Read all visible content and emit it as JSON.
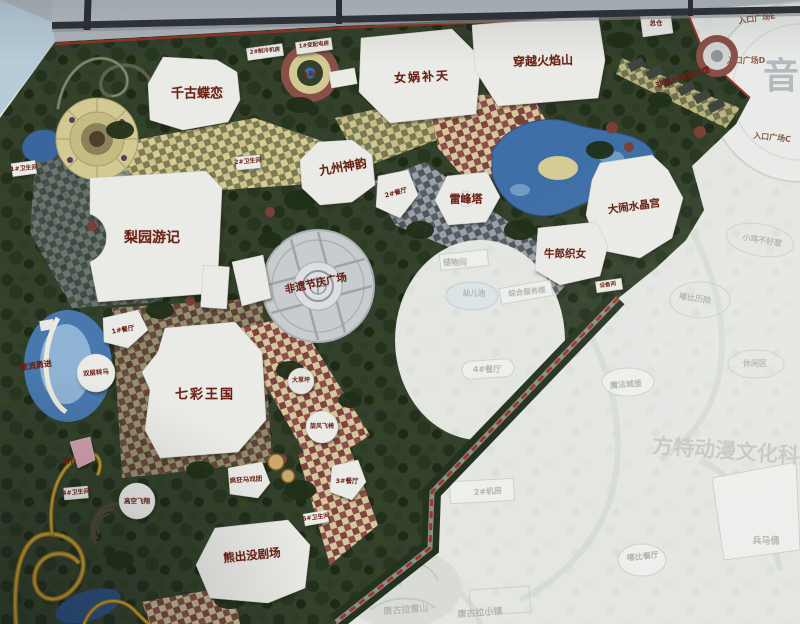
{
  "colors": {
    "attraction_label_red": "#6b2014",
    "faded_label_gray": "#b2b6af",
    "park_green": "#33402c",
    "water_blue": "#3f6fa8",
    "boundary_road_red": "#a03428",
    "plaza_gray": "#c8ccce",
    "building_white": "#eaeae6"
  },
  "map_labels": [
    {
      "id": "qiangu-dielian",
      "text": "千古蝶恋",
      "x": 197,
      "y": 94,
      "fs": 13,
      "type": "major"
    },
    {
      "id": "nvwa-butian",
      "text": "女娲补天",
      "x": 422,
      "y": 77,
      "fs": 12,
      "ls": 2,
      "rot": -3,
      "type": "major"
    },
    {
      "id": "chuanyue-huoyanshan",
      "text": "穿越火焰山",
      "x": 543,
      "y": 61,
      "fs": 12,
      "rot": -2,
      "type": "major"
    },
    {
      "id": "jiuzhou-shenyun",
      "text": "九州神韵",
      "x": 343,
      "y": 167,
      "fs": 12,
      "rot": -10,
      "type": "major"
    },
    {
      "id": "leifeng-ta",
      "text": "雷峰塔",
      "x": 466,
      "y": 199,
      "fs": 11,
      "type": "major"
    },
    {
      "id": "danao-shuijinggong",
      "text": "大闹水晶宫",
      "x": 634,
      "y": 207,
      "fs": 10.5,
      "rot": -8,
      "type": "major"
    },
    {
      "id": "niulang-zhinv",
      "text": "牛郎织女",
      "x": 565,
      "y": 254,
      "fs": 10.5,
      "type": "major"
    },
    {
      "id": "liyuan-youji",
      "text": "梨园游记",
      "x": 152,
      "y": 238,
      "fs": 14,
      "type": "major"
    },
    {
      "id": "qicai-wangguo",
      "text": "七彩王国",
      "x": 205,
      "y": 395,
      "fs": 13,
      "ls": 2,
      "type": "major"
    },
    {
      "id": "xiongchumo-juchang",
      "text": "熊出没剧场",
      "x": 252,
      "y": 556,
      "fs": 11.5,
      "rot": -6,
      "type": "major"
    },
    {
      "id": "feiyi-jieqing-guangchang",
      "text": "非遗节庆广场",
      "x": 316,
      "y": 284,
      "fs": 10.5,
      "rot": -12,
      "type": "major"
    },
    {
      "id": "feiyi-xiaozhen-exhibit",
      "text": "非遗小镇展示馆",
      "x": 683,
      "y": 78,
      "fs": 8,
      "rot": -17,
      "type": "major"
    },
    {
      "id": "jiliu-yongjin",
      "text": "激流勇进",
      "x": 36,
      "y": 366,
      "fs": 8,
      "rot": -8,
      "type": "major"
    },
    {
      "id": "zongcang",
      "text": "总仓",
      "x": 656,
      "y": 23,
      "fs": 6.5,
      "type": "minor"
    },
    {
      "id": "lengji-fang",
      "text": "2#制冷机房",
      "x": 265,
      "y": 52,
      "fs": 5.5,
      "rot": -6,
      "type": "minor"
    },
    {
      "id": "peidian-fang",
      "text": "1#变配电房",
      "x": 314,
      "y": 46,
      "fs": 5.5,
      "rot": -6,
      "type": "minor"
    },
    {
      "id": "yufu-shan",
      "text": "鱼凫山",
      "x": 311,
      "y": 75,
      "fs": 6,
      "rot": -5,
      "type": "minor"
    },
    {
      "id": "restroom-1",
      "text": "1#卫生间",
      "x": 24,
      "y": 169,
      "fs": 6,
      "rot": -5,
      "type": "minor"
    },
    {
      "id": "restroom-2",
      "text": "2#卫生间",
      "x": 248,
      "y": 162,
      "fs": 6,
      "rot": -5,
      "type": "minor"
    },
    {
      "id": "restaurant-2",
      "text": "2#餐厅",
      "x": 396,
      "y": 193,
      "fs": 6.5,
      "rot": -15,
      "type": "minor"
    },
    {
      "id": "restaurant-1",
      "text": "1#餐厅",
      "x": 123,
      "y": 330,
      "fs": 6.5,
      "rot": -10,
      "type": "minor"
    },
    {
      "id": "shuangceng-zhuanma",
      "text": "双层转马",
      "x": 96,
      "y": 373,
      "fs": 6.5,
      "rot": -5,
      "type": "minor"
    },
    {
      "id": "da-caoping",
      "text": "大草坪",
      "x": 301,
      "y": 381,
      "fs": 6,
      "type": "minor"
    },
    {
      "id": "xuanfeng-feiyi",
      "text": "旋风飞椅",
      "x": 322,
      "y": 427,
      "fs": 6,
      "type": "minor"
    },
    {
      "id": "restaurant-3",
      "text": "3#餐厅",
      "x": 347,
      "y": 481,
      "fs": 6.5,
      "type": "minor"
    },
    {
      "id": "wutai",
      "text": "舞台",
      "x": 70,
      "y": 461,
      "fs": 6.5,
      "type": "minor"
    },
    {
      "id": "gaokong-feixiang",
      "text": "高空飞翔",
      "x": 137,
      "y": 501,
      "fs": 6.5,
      "type": "minor"
    },
    {
      "id": "restroom-4",
      "text": "4#卫生间",
      "x": 76,
      "y": 493,
      "fs": 6,
      "rot": -5,
      "type": "minor"
    },
    {
      "id": "fengkuang-maxituan",
      "text": "疯狂马戏团",
      "x": 246,
      "y": 480,
      "fs": 6.5,
      "rot": -4,
      "type": "minor"
    },
    {
      "id": "restroom-5",
      "text": "5#卫生间",
      "x": 316,
      "y": 518,
      "fs": 6,
      "rot": -8,
      "type": "minor"
    },
    {
      "id": "shebei-jian",
      "text": "设备间",
      "x": 608,
      "y": 286,
      "fs": 5.5,
      "rot": -8,
      "type": "minor"
    },
    {
      "id": "entrance-plaza-e",
      "text": "入口广场E",
      "x": 757,
      "y": 19,
      "fs": 8,
      "rot": -8,
      "type": "gate"
    },
    {
      "id": "entrance-plaza-d",
      "text": "入口广场D",
      "x": 746,
      "y": 61,
      "fs": 8,
      "type": "gate"
    },
    {
      "id": "entrance-plaza-c",
      "text": "入口广场C",
      "x": 772,
      "y": 138,
      "fs": 8,
      "rot": 6,
      "type": "gate"
    },
    {
      "id": "chuwu-jian",
      "text": "储物间",
      "x": 455,
      "y": 263,
      "fs": 8,
      "type": "faded"
    },
    {
      "id": "youer-chi",
      "text": "幼儿池",
      "x": 474,
      "y": 293,
      "fs": 7.5,
      "type": "faded"
    },
    {
      "id": "zonghe-fuwulou",
      "text": "综合服务楼",
      "x": 527,
      "y": 292,
      "fs": 7.5,
      "rot": -6,
      "type": "faded"
    },
    {
      "id": "restaurant-4",
      "text": "4#餐厅",
      "x": 487,
      "y": 370,
      "fs": 8,
      "type": "faded"
    },
    {
      "id": "mofa-chengbao",
      "text": "魔法城堡",
      "x": 626,
      "y": 385,
      "fs": 8,
      "rot": -4,
      "type": "faded"
    },
    {
      "id": "jifang-2",
      "text": "2#机房",
      "x": 488,
      "y": 492,
      "fs": 8,
      "rot": -4,
      "type": "faded"
    },
    {
      "id": "tanggula-xueshan",
      "text": "唐古拉雪山",
      "x": 406,
      "y": 611,
      "fs": 9,
      "rot": -4,
      "type": "faded"
    },
    {
      "id": "tanggula-xiaozhen",
      "text": "唐古拉小镇",
      "x": 480,
      "y": 614,
      "fs": 9,
      "rot": -4,
      "type": "faded"
    },
    {
      "id": "xiaoji-buhaore",
      "text": "小鸡不好惹",
      "x": 762,
      "y": 241,
      "fs": 8,
      "rot": 10,
      "type": "faded"
    },
    {
      "id": "dubi-lixian",
      "text": "嘟比历险",
      "x": 695,
      "y": 299,
      "fs": 8,
      "rot": 8,
      "type": "faded"
    },
    {
      "id": "xiuxian-qu",
      "text": "休闲区",
      "x": 755,
      "y": 364,
      "fs": 8,
      "type": "faded"
    },
    {
      "id": "dubi-canting",
      "text": "嘟比餐厅",
      "x": 643,
      "y": 557,
      "fs": 8,
      "rot": -6,
      "type": "faded"
    },
    {
      "id": "bingmayong",
      "text": "兵马俑",
      "x": 766,
      "y": 542,
      "fs": 9,
      "type": "faded"
    },
    {
      "id": "watermark-fangte",
      "text": "方特动漫文化科技",
      "x": 652,
      "y": 452,
      "fs": 21,
      "rot": 4,
      "anchor": "left",
      "type": "wm"
    },
    {
      "id": "watermark-yinyue",
      "text": "音乐",
      "x": 763,
      "y": 77,
      "fs": 36,
      "anchor": "left",
      "type": "wm2"
    }
  ]
}
